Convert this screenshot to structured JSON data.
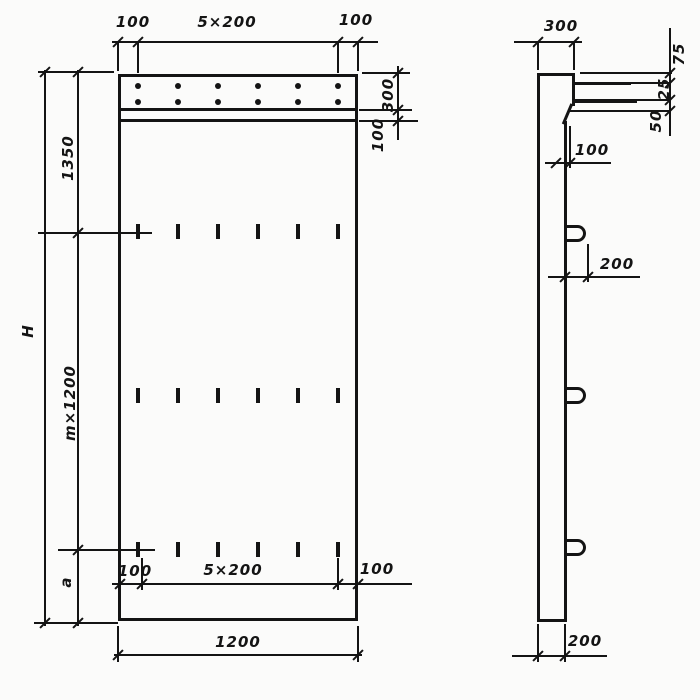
{
  "colors": {
    "ink": "#141414",
    "paper": "#fbfbfa"
  },
  "front_view": {
    "top_dim": {
      "left": "100",
      "middle": "5×200",
      "right": "100"
    },
    "right_dim": {
      "band": "300",
      "strip": "100"
    },
    "left_dim": {
      "upper": "1350",
      "middle": "m×1200",
      "lower": "a",
      "overall": "H"
    },
    "inner_bottom_dim": {
      "left": "100",
      "middle": "5×200",
      "right": "100"
    },
    "bottom_dim": {
      "overall": "1200"
    }
  },
  "side_view": {
    "top_dim": {
      "width": "300"
    },
    "right_dim": {
      "upper": "75",
      "middle": "25",
      "lower": "50"
    },
    "step_dim": "100",
    "loop_dim": "200",
    "bottom_dim": "200"
  }
}
